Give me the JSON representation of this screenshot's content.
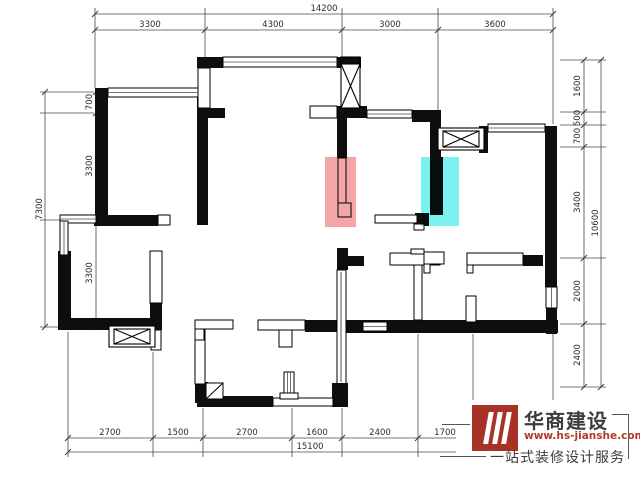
{
  "dimensions": {
    "top": {
      "total": "14200",
      "segments": [
        "3300",
        "4300",
        "3000",
        "3600"
      ]
    },
    "bottom": {
      "total": "15100",
      "segments": [
        "2700",
        "1500",
        "2700",
        "1600",
        "2400",
        "1700"
      ]
    },
    "left": {
      "total": "7300",
      "segments": [
        "700",
        "3300",
        "3300"
      ]
    },
    "right": {
      "total": "10600",
      "segments": [
        "1600",
        "500",
        "700",
        "3400",
        "2000",
        "2400"
      ]
    }
  },
  "highlights": {
    "pink_wall_color": "#ee6e6e",
    "cyan_wall_color": "#2ce9e9"
  },
  "logo": {
    "company": "华商建设",
    "website": "www.hs-jianshe.com",
    "tagline": "一站式装修设计服务",
    "brand_color": "#a93226"
  }
}
